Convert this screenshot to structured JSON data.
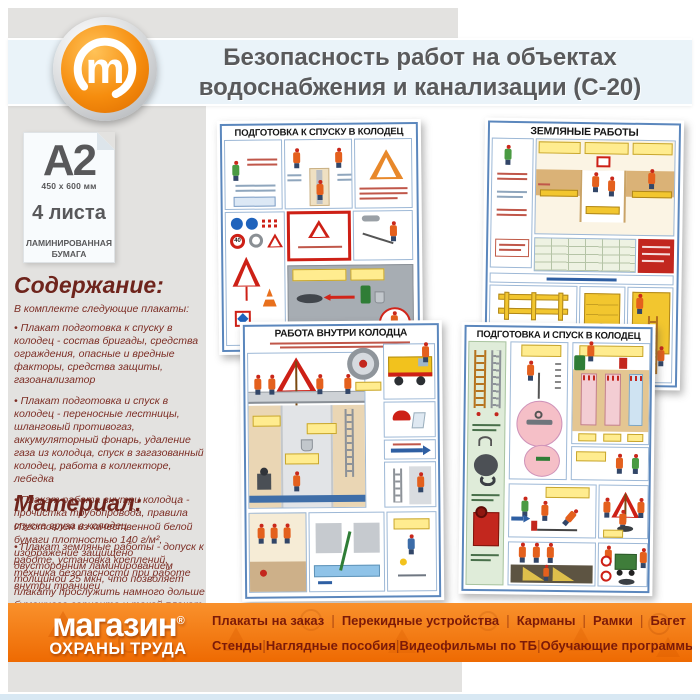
{
  "header": {
    "title_line1": "Безопасность работ на объектах",
    "title_line2": "водоснабжения и канализации (С-20)"
  },
  "format_card": {
    "format": "A2",
    "dimensions": "450 x 600 мм",
    "sheets": "4 листа",
    "paper_line1": "ЛАМИНИРОВАННАЯ",
    "paper_line2": "БУМАГА"
  },
  "contents": {
    "heading": "Содержание:",
    "intro": "В комплекте следующие плакаты:",
    "items": [
      "Плакат подготовка к спуску в колодец - состав бригады, средства ограждения, опасные и вредные факторы, средства защиты, газоанализатор",
      "Плакат подготовка и спуск в колодец - переносные лестницы, шланговый противогаз, аккумуляторный фонарь, удаление газа из колодца, спуск в загазованный колодец, работа в коллекторе, лебедка",
      "Плакат работа внутри колодца - прочистка трубопровода, правила спуска груза в колодец",
      "Плакат земляные работы - допуск к работе, установка креплений, техника безопасности при работе внутри траншеи"
    ]
  },
  "material": {
    "heading": "Материал:",
    "text": "Изготовлен из качественной белой бумаги плотностью 140 г/м², изображение защищено двусторонним ламинированием толщиной 25 мкн, что позволяет плакату прослужить намного дольше бумажного варианта и такой плакат не боится влаги - его смело можно протирать."
  },
  "posters": [
    {
      "title": "ПОДГОТОВКА К СПУСКУ В КОЛОДЕЦ",
      "sign_speed": "40"
    },
    {
      "title": "ЗЕМЛЯНЫЕ РАБОТЫ"
    },
    {
      "title": "РАБОТА ВНУТРИ КОЛОДЦА"
    },
    {
      "title": "ПОДГОТОВКА И СПУСК В КОЛОДЕЦ"
    }
  ],
  "footer": {
    "logo_line1": "магазин",
    "reg_mark": "®",
    "logo_line2": "ОХРАНЫ ТРУДА",
    "menu_row1": [
      "Плакаты на заказ",
      "Перекидные устройства",
      "Карманы",
      "Рамки",
      "Багет"
    ],
    "menu_row2": [
      "Стенды",
      "Наглядные пособия",
      "Видеофильмы по ТБ",
      "Обучающие программы"
    ]
  },
  "colors": {
    "accent_orange": "#ee6a02",
    "maroon_text": "#7c2d24",
    "band_blue": "#eaf3f9",
    "poster_frame_blue": "#5b87bd",
    "gray_panel": "#e3e2e0"
  }
}
